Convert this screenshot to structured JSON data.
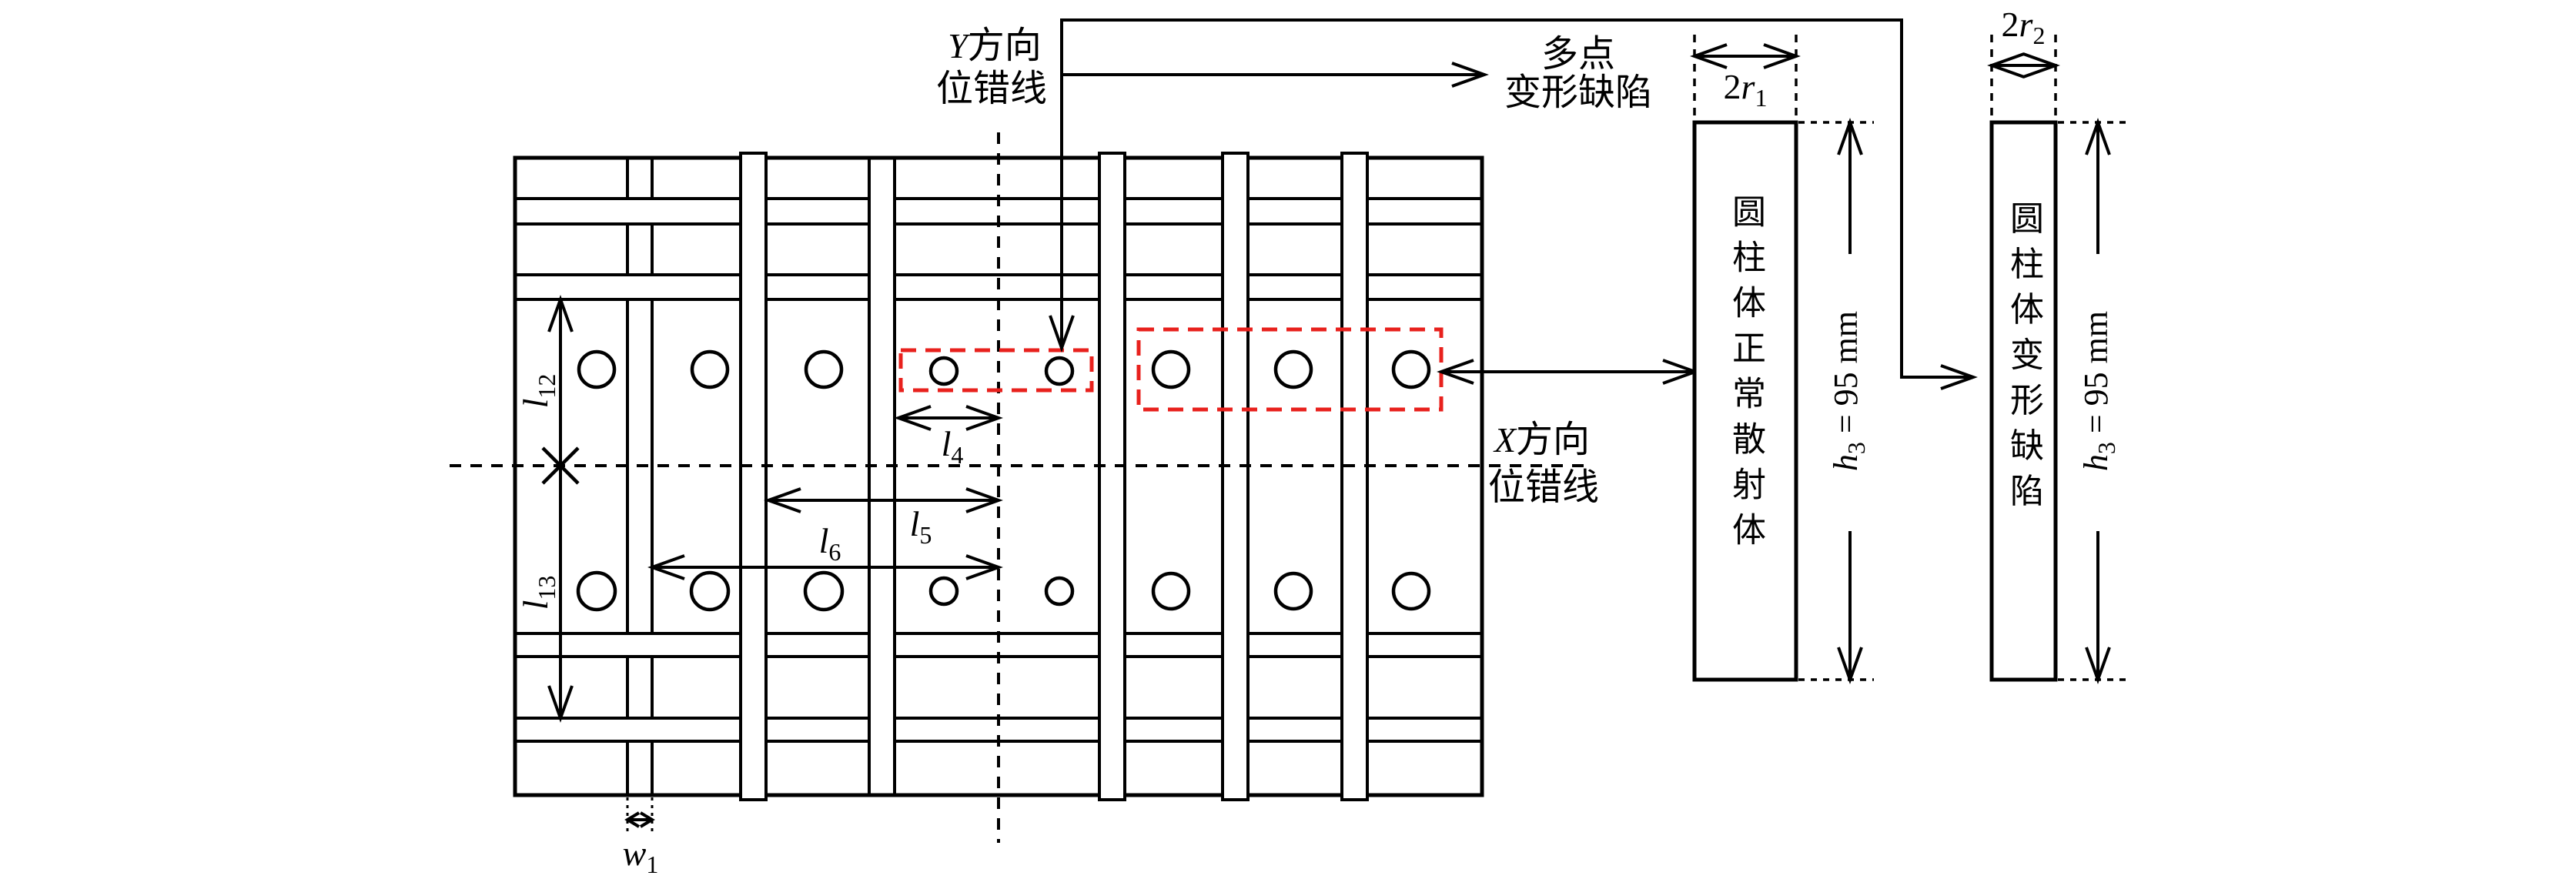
{
  "diagram": {
    "labels": {
      "y_line": {
        "var": "Y",
        "l1": "方向",
        "l2": "位错线"
      },
      "x_line": {
        "var": "X",
        "l1": "方向",
        "l2": "位错线"
      },
      "multipoint": {
        "l1": "多点",
        "l2": "变形缺陷"
      },
      "cyl_normal": "圆柱体正常散射体",
      "cyl_deformed": "圆柱体变形缺陷"
    },
    "dims": {
      "r1": {
        "prefix": "2",
        "var": "r",
        "sub": "1",
        "rest": ""
      },
      "r2": {
        "prefix": "2",
        "var": "r",
        "sub": "2",
        "rest": ""
      },
      "h3_left": {
        "prefix": "",
        "var": "h",
        "sub": "3",
        "rest": " = 95 mm"
      },
      "h3_right": {
        "prefix": "",
        "var": "h",
        "sub": "3",
        "rest": " = 95 mm"
      },
      "l4": {
        "prefix": "",
        "var": "l",
        "sub": "4",
        "rest": ""
      },
      "l5": {
        "prefix": "",
        "var": "l",
        "sub": "5",
        "rest": ""
      },
      "l6": {
        "prefix": "",
        "var": "l",
        "sub": "6",
        "rest": ""
      },
      "l12": {
        "prefix": "",
        "var": "l",
        "sub": "12",
        "rest": ""
      },
      "l13": {
        "prefix": "",
        "var": "l",
        "sub": "13",
        "rest": ""
      },
      "w1": {
        "prefix": "",
        "var": "w",
        "sub": "1",
        "rest": ""
      }
    },
    "colors": {
      "line": "#000000",
      "defect_box": "#e8211d",
      "background": "#ffffff"
    }
  }
}
